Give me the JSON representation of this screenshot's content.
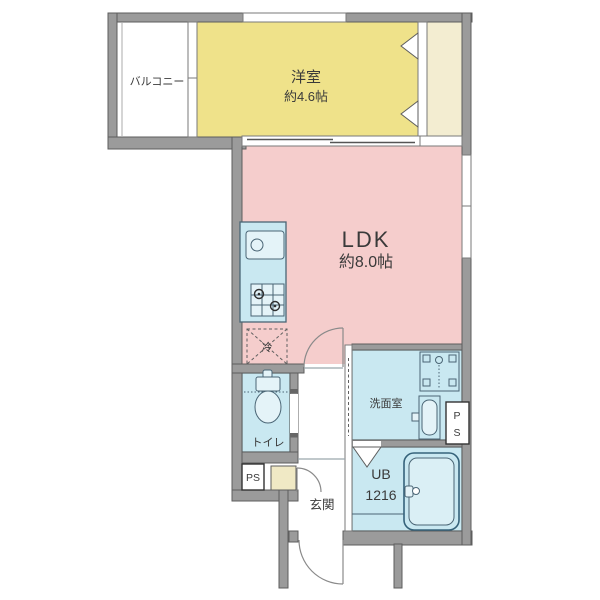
{
  "floorplan": {
    "rooms": {
      "balcony": {
        "label": "バルコニー"
      },
      "western_room": {
        "label": "洋室",
        "size": "約4.6帖"
      },
      "ldk": {
        "label": "LDK",
        "size": "約8.0帖"
      },
      "toilet": {
        "label": "トイレ"
      },
      "washroom": {
        "label": "洗面室"
      },
      "entrance": {
        "label": "玄関"
      },
      "unit_bath": {
        "label": "UB",
        "size": "1216"
      },
      "refrigerator_space": {
        "label": "冷"
      },
      "pipe_space_bottom_left": {
        "label": "PS"
      },
      "pipe_space_right": {
        "line1": "P",
        "line2": "S"
      }
    },
    "colors": {
      "wall": "#9B9B9B",
      "wall_outline": "#5E5E5E",
      "western_room": "#EFE28A",
      "closet": "#F3EDD1",
      "ldk": "#F5CDCC",
      "wet_area": "#C9E8F1",
      "fixture_light": "#E4F3F8",
      "tub_inner": "#DAEFF5",
      "shoe_cabinet": "#F0E9C5",
      "fixture_outline": "#4A6575",
      "door_line": "#8A8A8A",
      "text": "#3A3A3A"
    }
  }
}
